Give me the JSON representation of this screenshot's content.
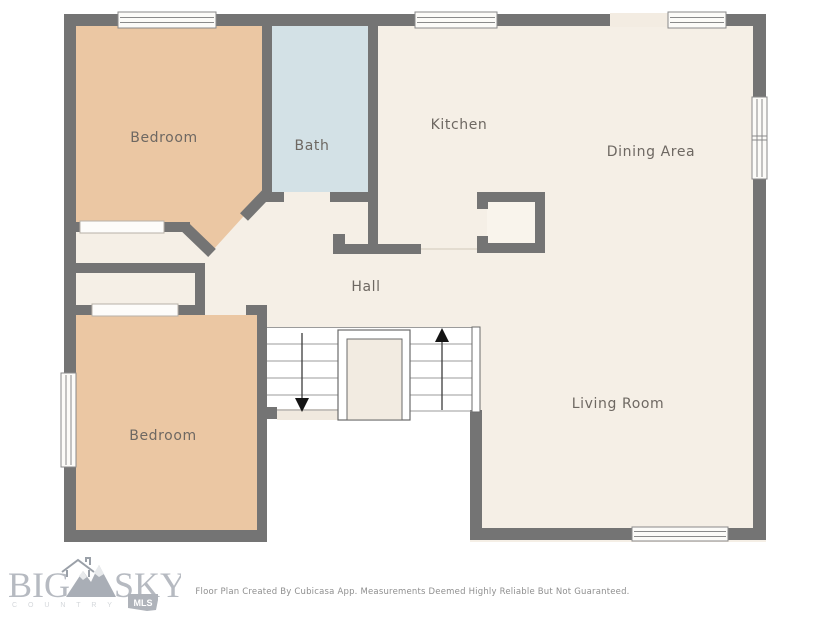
{
  "plan": {
    "rooms": {
      "bedroom_top": "Bedroom",
      "bath": "Bath",
      "kitchen": "Kitchen",
      "dining": "Dining Area",
      "hall": "Hall",
      "bedroom_bottom": "Bedroom",
      "living": "Living Room"
    },
    "colors": {
      "wall": "#747474",
      "floor": "#f5efe6",
      "bedroom_floor": "#ebc7a3",
      "bath_floor": "#d3e1e6",
      "label_text": "#6e6862"
    }
  },
  "branding": {
    "logo_word_1": "BIG",
    "logo_word_2": "SKY",
    "logo_subtext": "C O U N T R Y",
    "logo_badge": "MLS"
  },
  "footer": {
    "disclaimer": "Floor Plan Created By Cubicasa App. Measurements Deemed Highly Reliable But Not Guaranteed."
  }
}
